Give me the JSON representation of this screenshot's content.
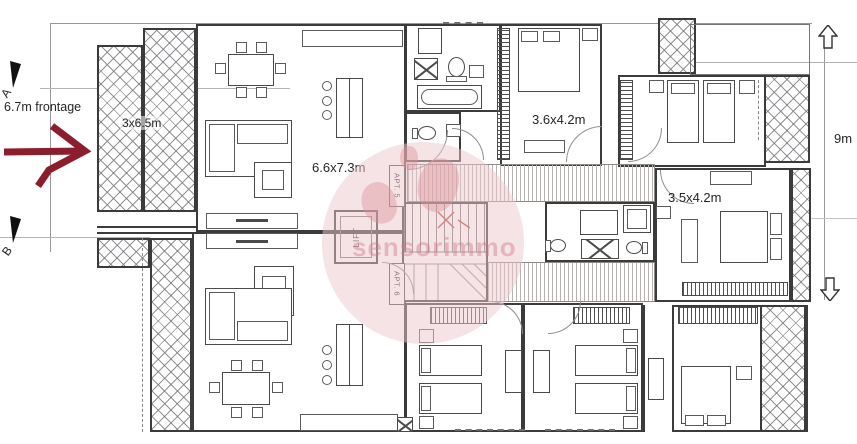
{
  "annotations": {
    "section_marker_top": "A",
    "section_marker_bottom": "B",
    "frontage_label": "6.7m frontage",
    "depth_label": "9m"
  },
  "room_labels": {
    "balcony": "3x6.5m",
    "living": "6.6x7.3m",
    "bedroom_top": "3.6x4.2m",
    "bedroom_right": "3.5x4.2m"
  },
  "core_labels": {
    "lift": "LIFT",
    "apt5": "APT. 5",
    "apt6": "APT. 6"
  },
  "watermark": {
    "text": "sensorimmo"
  },
  "colors": {
    "annotation_arrow": "#8c1d2c",
    "stair_marks": "#c23b3b",
    "watermark_pink": "#e7bcc2",
    "wall_line": "#3b3b3b"
  }
}
